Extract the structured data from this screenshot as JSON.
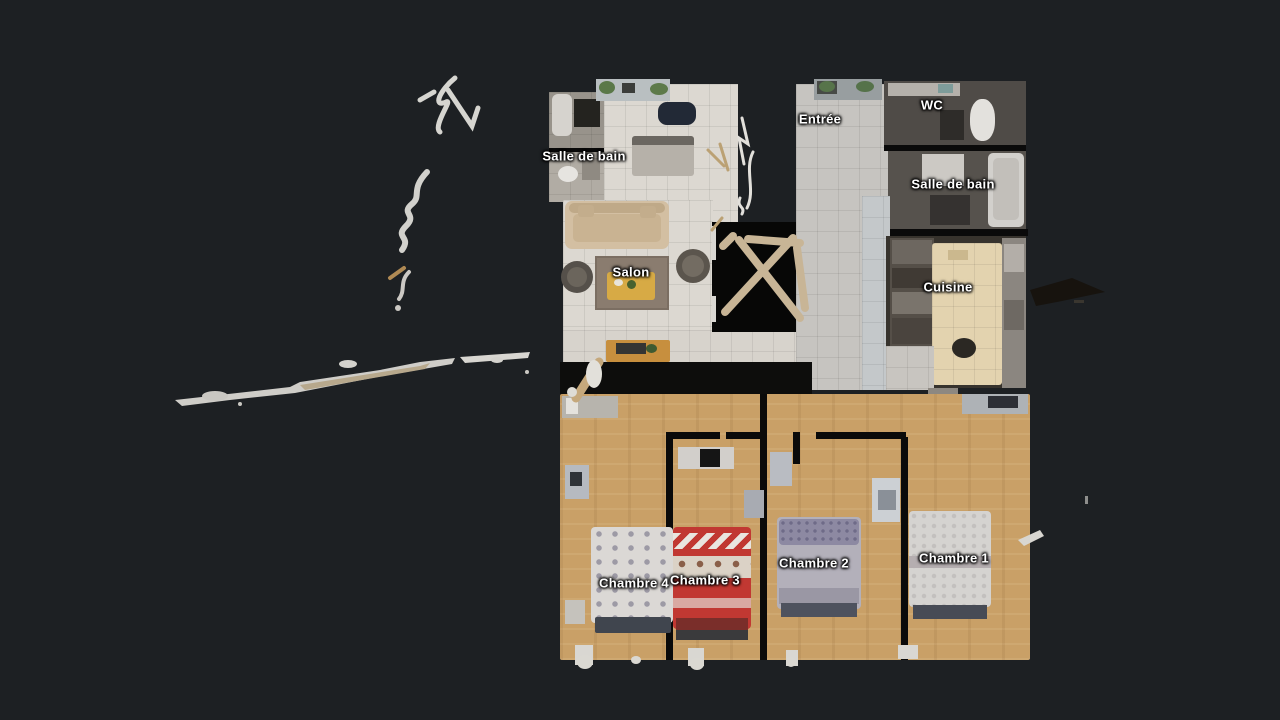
{
  "scene": {
    "app": "dollhouse-floorplan-view",
    "background": "#1d2023",
    "label_color": "#ffffff",
    "floor_upper_tile": "#dcd8d1",
    "floor_corridor_tile": "#c6c4c0",
    "floor_wood": "#c9a067",
    "wet_room_dark": "#56524d",
    "kitchen_island": "#e3d3af"
  },
  "rooms": [
    {
      "id": "salle-de-bain-1",
      "label": "Salle de bain"
    },
    {
      "id": "entree",
      "label": "Entrée"
    },
    {
      "id": "wc",
      "label": "WC"
    },
    {
      "id": "salle-de-bain-2",
      "label": "Salle de bain"
    },
    {
      "id": "salon",
      "label": "Salon"
    },
    {
      "id": "cuisine",
      "label": "Cuisine"
    },
    {
      "id": "chambre-4",
      "label": "Chambre 4"
    },
    {
      "id": "chambre-3",
      "label": "Chambre 3"
    },
    {
      "id": "chambre-2",
      "label": "Chambre 2"
    },
    {
      "id": "chambre-1",
      "label": "Chambre 1"
    }
  ],
  "beds": [
    {
      "room": "Chambre 4",
      "color": "#dbd8d5",
      "pattern": "grey polka dots"
    },
    {
      "room": "Chambre 3",
      "color": "#c13832",
      "pattern": "white/red nordic hearts"
    },
    {
      "room": "Chambre 2",
      "color": "#b3b0ba",
      "pattern": "blue-grey dotted pillow"
    },
    {
      "room": "Chambre 1",
      "color": "#d5d3d0",
      "pattern": "white textured"
    }
  ]
}
